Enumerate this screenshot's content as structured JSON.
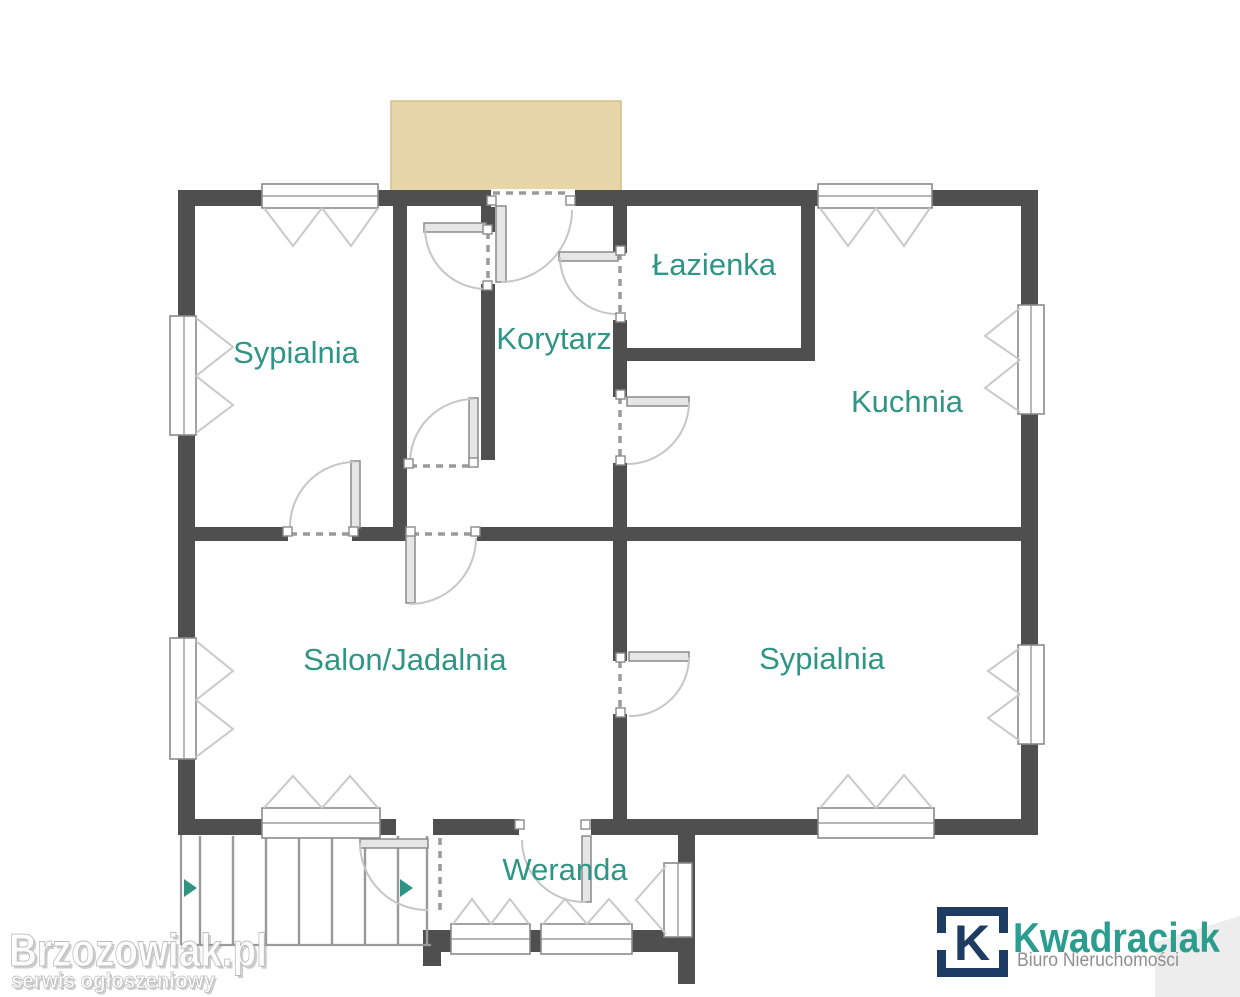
{
  "floorplan": {
    "rooms": [
      {
        "name": "bedroom-top-left",
        "label": "Sypialnia"
      },
      {
        "name": "corridor",
        "label": "Korytarz"
      },
      {
        "name": "bathroom",
        "label": "Łazienka"
      },
      {
        "name": "kitchen",
        "label": "Kuchnia"
      },
      {
        "name": "living-dining",
        "label": "Salon/Jadalnia"
      },
      {
        "name": "bedroom-bottom-right",
        "label": "Sypialnia"
      },
      {
        "name": "veranda",
        "label": "Weranda"
      }
    ],
    "colors": {
      "wall": "#4f4f4f",
      "room_label": "#2f9586",
      "terrace_fill": "#e7d6a7",
      "stair_arrow": "#2f9384",
      "symbol_line": "#9a9a9a"
    }
  },
  "watermark": {
    "title": "Brzozowiak.pl",
    "subtitle": "serwis ogłoszeniowy"
  },
  "logo": {
    "initial": "K",
    "brand": "Kwadraciak",
    "tagline": "Biuro Nieruchomości",
    "colors": {
      "navy": "#1e3c63",
      "teal": "#2a9d8f",
      "tagline_gray": "#8f8f8f"
    }
  }
}
